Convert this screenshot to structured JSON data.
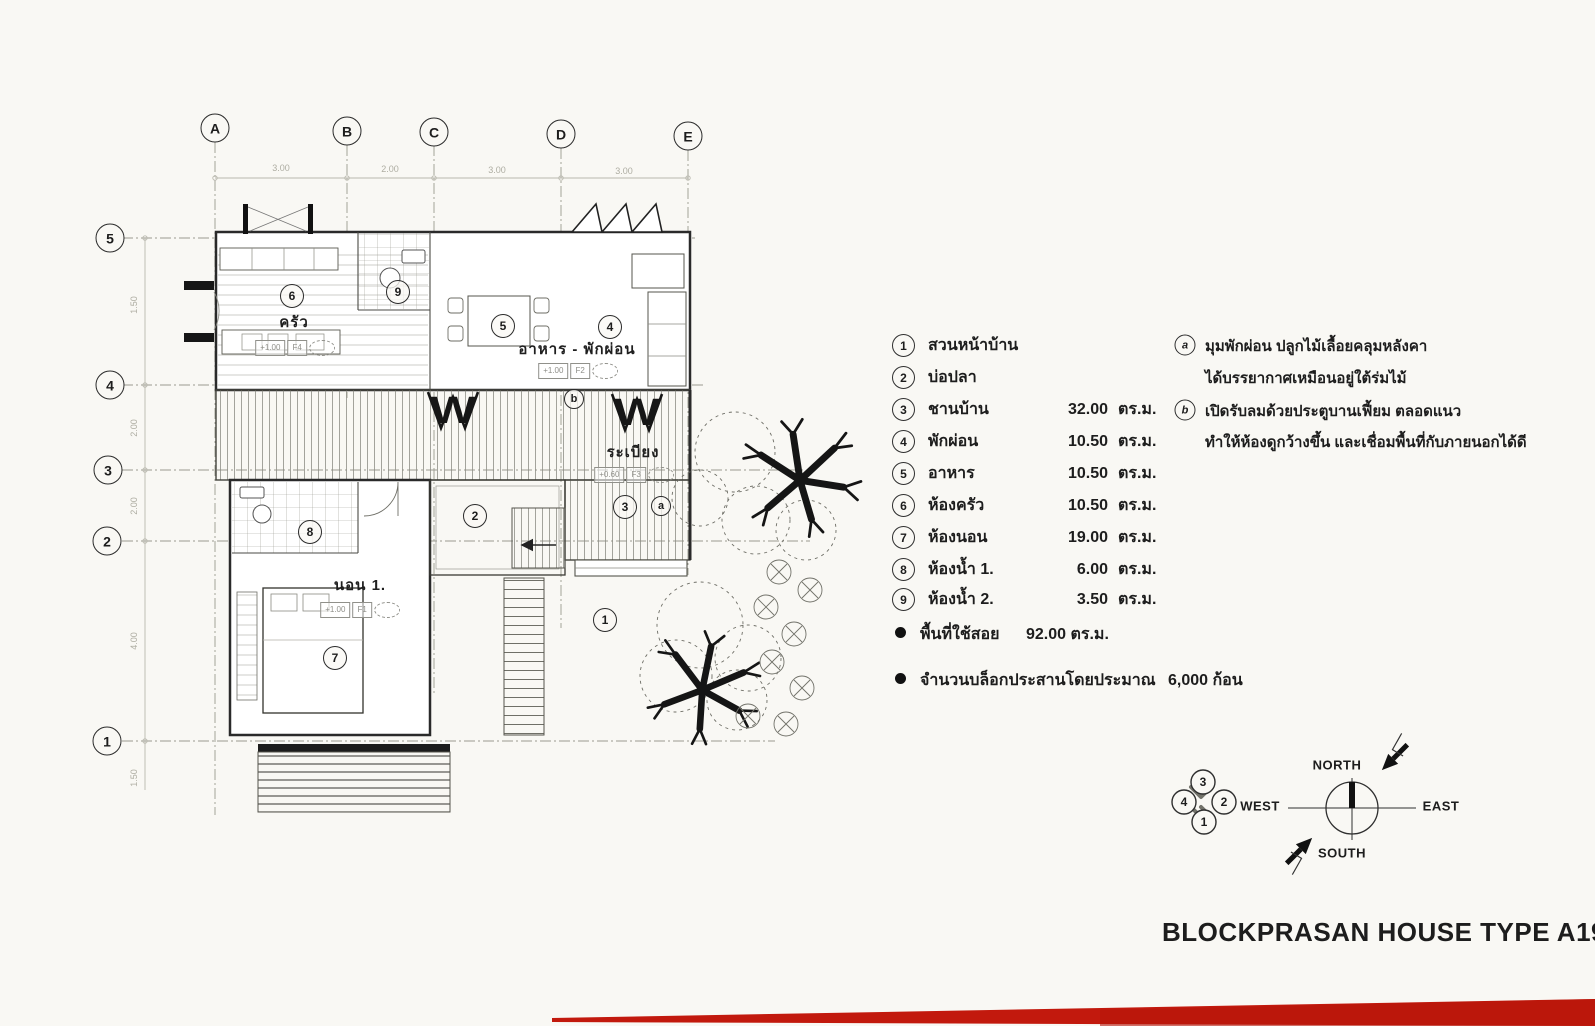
{
  "page": {
    "title": "BLOCKPRASAN HOUSE TYPE  A19."
  },
  "grid": {
    "columns": [
      "A",
      "B",
      "C",
      "D",
      "E"
    ],
    "column_dims": [
      "3.00",
      "2.00",
      "3.00",
      "3.00"
    ],
    "rows": [
      "5",
      "4",
      "3",
      "2",
      "1"
    ],
    "row_dims": [
      "1.50",
      "2.00",
      "2.00",
      "4.00",
      "1.50"
    ]
  },
  "plan": {
    "room_labels": {
      "kitchen": "ครัว",
      "dining_living": "อาหาร - พักผ่อน",
      "terrace": "ระเบียง",
      "bedroom": "นอน 1."
    },
    "circles": {
      "n1": "1",
      "n2": "2",
      "n3": "3",
      "n4": "4",
      "n5": "5",
      "n6": "6",
      "n7": "7",
      "n8": "8",
      "n9": "9",
      "a": "a",
      "b": "b"
    },
    "levels": {
      "kitchen_value": "+1.00",
      "kitchen_floor": "F4",
      "living_value": "+1.00",
      "living_floor": "F2",
      "terrace_value": "+0.60",
      "terrace_floor": "F3",
      "bedroom_value": "+1.00",
      "bedroom_floor": "F1"
    },
    "door_symbol": "W"
  },
  "legend": {
    "items": [
      {
        "num": "1",
        "name": "สวนหน้าบ้าน",
        "area": "",
        "unit": ""
      },
      {
        "num": "2",
        "name": "บ่อปลา",
        "area": "",
        "unit": ""
      },
      {
        "num": "3",
        "name": "ชานบ้าน",
        "area": "32.00",
        "unit": "ตร.ม."
      },
      {
        "num": "4",
        "name": "พักผ่อน",
        "area": "10.50",
        "unit": "ตร.ม."
      },
      {
        "num": "5",
        "name": "อาหาร",
        "area": "10.50",
        "unit": "ตร.ม."
      },
      {
        "num": "6",
        "name": "ห้องครัว",
        "area": "10.50",
        "unit": "ตร.ม."
      },
      {
        "num": "7",
        "name": "ห้องนอน",
        "area": "19.00",
        "unit": "ตร.ม."
      },
      {
        "num": "8",
        "name": "ห้องน้ำ 1.",
        "area": "6.00",
        "unit": "ตร.ม."
      },
      {
        "num": "9",
        "name": "ห้องน้ำ 2.",
        "area": "3.50",
        "unit": "ตร.ม."
      }
    ]
  },
  "notes": [
    {
      "marker": "a",
      "line1": "มุมพักผ่อน ปลูกไม้เลื้อยคลุมหลังคา",
      "line2": "ได้บรรยากาศเหมือนอยู่ใต้ร่มไม้"
    },
    {
      "marker": "b",
      "line1": "เปิดรับลมด้วยประตูบานเฟี้ยม ตลอดแนว",
      "line2": "ทำให้ห้องดูกว้างขึ้น และเชื่อมพื้นที่กับภายนอกได้ดี"
    }
  ],
  "summary": [
    {
      "label": "พื้นที่ใช้สอย",
      "value": "92.00 ตร.ม."
    },
    {
      "label": "จำนวนบล็อกประสานโดยประมาณ",
      "value": "6,000 ก้อน"
    }
  ],
  "compass": {
    "north": "NORTH",
    "south": "SOUTH",
    "west": "WEST",
    "east": "EAST",
    "cluster": [
      "3",
      "4",
      "2",
      "1"
    ]
  },
  "colors": {
    "accent_red": "#c2190d",
    "paper": "#f9f8f4",
    "ink": "#1d1d1d"
  }
}
